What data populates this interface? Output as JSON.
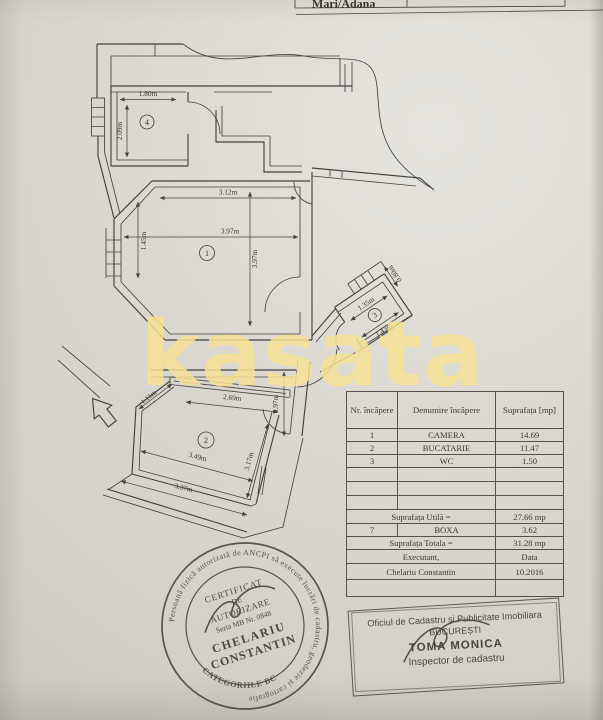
{
  "page": {
    "top_strip_text": "Mari/Adana"
  },
  "watermark": {
    "text": "kasata",
    "color": "#f4df9b"
  },
  "plan": {
    "room_numbers": {
      "r1": "1",
      "r2": "2",
      "r3": "3",
      "r4": "4"
    },
    "dims": {
      "r4_width": "1.80m",
      "r4_height": "2.09m",
      "r1_top": "3.12m",
      "r1_width": "3.97m",
      "r1_height": "3.97m",
      "r1_left": "1.45m",
      "r3_top": "1.35m",
      "r3_bottom": "1.43m",
      "r3_side": "0.80m",
      "r2_top": "2.69m",
      "r2_chamfer": "1.11m",
      "r2_entry": "0.97m",
      "r2_mid": "3.49m",
      "r2_bottom": "3.37m",
      "r2_right": "3.17m"
    }
  },
  "table": {
    "headers": {
      "col1": "Nr. încăpere",
      "col2": "Denumire încăpere",
      "col3": "Suprafața [mp]"
    },
    "rows": [
      {
        "nr": "1",
        "name": "CAMERA",
        "area": "14.69"
      },
      {
        "nr": "2",
        "name": "BUCATARIE",
        "area": "11.47"
      },
      {
        "nr": "3",
        "name": "WC",
        "area": "1.50"
      }
    ],
    "utila_label": "Suprafața Utilă =",
    "utila_value": "27.66 mp",
    "boxa": {
      "nr": "7",
      "name": "BOXA",
      "area": "3.62"
    },
    "totala_label": "Suprafața Totala  =",
    "totala_value": "31.28 mp",
    "executant_label": "Executant,",
    "data_label": "Data",
    "executant_name": "Chelariu Constantin",
    "date_value": "10.2016"
  },
  "stamps": {
    "office": {
      "line1": "Oficiul de Cadastru și Publicitate Imobiliara",
      "line2": "BUCUREȘTI",
      "name": "TOMA MONICA",
      "title": "Inspector de cadastru"
    },
    "surveyor": {
      "ring_text": "Persoană fizică autorizată de ANCPI să execute lucrări de cadastru, geodezie și cartografie",
      "bottom_text": "CATEGORIILE BC",
      "line1": "CERTIFICAT",
      "line2": "DE",
      "line3": "AUTORIZARE",
      "serial": "Seria MB Nr. 0848",
      "name1": "CHELARIU",
      "name2": "CONSTANTIN"
    }
  }
}
